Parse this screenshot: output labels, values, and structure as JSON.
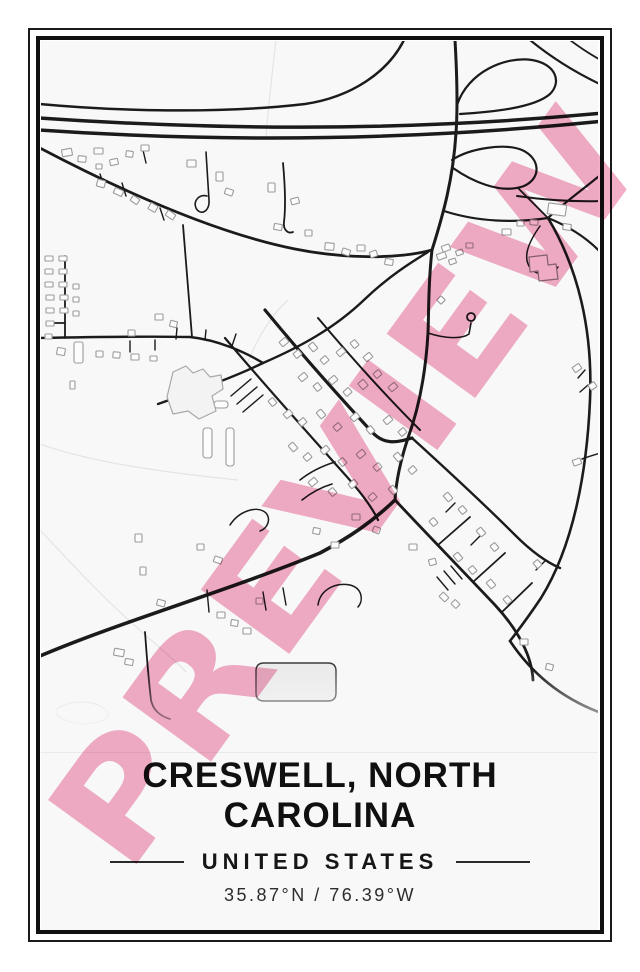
{
  "caption": {
    "title_line1": "CRESWELL, NORTH",
    "title_line2": "CAROLINA",
    "country": "UNITED STATES",
    "coordinates": "35.87°N / 76.39°W"
  },
  "watermark": {
    "text": "PREVIEW",
    "color": "#f2a7c2",
    "opacity": 0.92,
    "font_size": 150,
    "rotation": -54,
    "cx": 346,
    "cy": 489,
    "text_length": 885
  },
  "map": {
    "colors": {
      "background": "#f8f8f8",
      "road": "#1b1b1b",
      "building_stroke": "#9b9b9b",
      "building_fill": "#fcfcfc",
      "contour": "#e4e4e4",
      "frame": "#111111",
      "cut_line": "#eaeaea"
    },
    "roads": [
      {
        "d": "M404,40 C388,72 352,97 305,104 C220,114 115,111 40,104",
        "w": 2.5
      },
      {
        "d": "M40,118 C200,129 390,133 604,113",
        "w": 3.5
      },
      {
        "d": "M40,130 C200,141 390,143 604,121",
        "w": 3.5
      },
      {
        "d": "M455,40 C457,75 458,105 456,133 C453,180 443,215 432,250 C428,285 429,310 428,333 C426,368 420,405 408,438 C400,462 396,482 395,500",
        "w": 3
      },
      {
        "d": "M457,105 C468,72 505,56 532,60 C556,64 562,82 550,94 C534,108 492,112 460,114",
        "w": 2.2
      },
      {
        "d": "M452,160 C470,148 505,143 522,150 C540,158 542,178 524,186 C500,195 470,180 453,168",
        "w": 2.2
      },
      {
        "d": "M530,40 C552,58 578,74 604,86",
        "w": 2.2
      },
      {
        "d": "M570,40 C583,50 595,57 604,62",
        "w": 1.8
      },
      {
        "d": "M604,172 C585,188 565,202 548,218",
        "w": 2.2
      },
      {
        "d": "M517,196 C545,200 575,202 604,201",
        "w": 2
      },
      {
        "d": "M444,211 C478,222 515,223 548,218",
        "w": 2.2
      },
      {
        "d": "M548,218 C568,226 588,238 604,256",
        "w": 2.2
      },
      {
        "d": "M548,218 C537,207 527,197 518,188",
        "w": 1.8
      },
      {
        "d": "M548,218 C578,268 593,330 590,400 C587,470 574,545 541,598 C531,613 520,628 510,641",
        "w": 2.6
      },
      {
        "d": "M510,641 C536,680 570,702 604,714",
        "w": 2.6
      },
      {
        "d": "M40,148 C120,190 215,233 295,249 C340,258 395,260 432,250",
        "w": 2.8
      },
      {
        "d": "M158,404 C195,391 232,378 263,363 C300,347 335,328 365,299 C388,277 410,263 428,252",
        "w": 2.4
      },
      {
        "d": "M40,338 C90,337 140,336 190,337 C218,340 245,352 263,363",
        "w": 2.4
      },
      {
        "d": "M65,256 L65,338 M52,323 L65,323",
        "w": 1.8
      },
      {
        "d": "M183,225 C186,262 189,300 192,337",
        "w": 1.8
      },
      {
        "d": "M40,656 C120,622 230,590 320,553 C350,537 372,522 395,500",
        "w": 3.6
      },
      {
        "d": "M265,310 C298,350 335,392 372,432 C385,446 398,442 412,438",
        "w": 3.2
      },
      {
        "d": "M395,500 C425,532 460,568 495,605 C520,632 532,658 533,680",
        "w": 2.8
      },
      {
        "d": "M412,438 C445,468 480,500 515,535 C532,552 546,562 560,568",
        "w": 2.4
      },
      {
        "d": "M318,318 C350,356 385,395 420,430",
        "w": 2
      },
      {
        "d": "M225,338 C262,382 305,430 348,478 C362,494 372,507 378,520",
        "w": 2.2
      },
      {
        "d": "M438,545 L470,517 M473,582 L505,553 M502,612 L532,583",
        "w": 1.8
      },
      {
        "d": "M231,396 L251,379 M237,404 L257,387 M243,412 L263,395",
        "w": 1.4
      },
      {
        "d": "M130,341 L130,352 M155,340 L155,350 M176,339 L177,328 M205,340 L206,330 M232,346 L236,334",
        "w": 1.4
      },
      {
        "d": "M100,174 L104,186 M122,183 L126,196 M143,150 L146,163 M160,208 L164,220",
        "w": 1.4
      },
      {
        "d": "M206,152 L209,200 C210,212 200,216 196,208 C193,201 199,194 207,196",
        "w": 1.6
      },
      {
        "d": "M283,163 C285,185 286,205 284,222 C283,230 288,234 293,232",
        "w": 1.8
      },
      {
        "d": "M428,333 C446,339 462,339 469,334 L471,323",
        "w": 1.6
      },
      {
        "d": "M145,632 C147,660 149,683 151,700 C153,710 160,716 170,719",
        "w": 1.8
      },
      {
        "d": "M230,525 C239,511 257,505 266,513 C271,519 268,528 260,531",
        "w": 1.5
      },
      {
        "d": "M318,605 C320,590 335,582 350,585 C362,588 364,600 358,607",
        "w": 1.5
      },
      {
        "d": "M540,226 C528,243 522,258 531,269 C540,277 552,276 558,267",
        "w": 1.5
      },
      {
        "d": "M207,590 L209,612 M263,592 L266,610 M283,588 L286,605",
        "w": 1.4
      },
      {
        "d": "M437,577 L448,590 M444,571 L455,584 M451,566 L462,579",
        "w": 1.4
      },
      {
        "d": "M455,503 L446,512 M480,536 L471,545 M536,570 L545,561",
        "w": 1.4
      },
      {
        "d": "M582,459 C590,456 597,454 604,452",
        "w": 1.5
      },
      {
        "d": "M585,370 L578,378 M588,385 L580,392",
        "w": 1.4
      },
      {
        "d": "M300,480 C310,472 322,466 335,462 M302,500 C312,492 322,487 332,484",
        "w": 1.6
      }
    ],
    "circles": [
      {
        "cx": 471,
        "cy": 317,
        "r": 4
      }
    ],
    "contours": [
      {
        "d": "M276,40 C272,75 268,108 266,138"
      },
      {
        "d": "M288,300 C274,312 258,336 248,362"
      },
      {
        "d": "M40,444 C90,462 160,472 238,480"
      },
      {
        "d": "M40,530 C70,562 105,600 142,632 C162,650 175,660 186,672"
      },
      {
        "d": "M58,708 C76,698 100,701 108,713 C111,721 88,727 71,722 C59,718 52,714 58,708"
      }
    ],
    "shapes": [
      {
        "d": "M167,397 L173,372 L186,366 L193,373 L203,369 L210,377 L221,375 L223,389 L212,396 L216,411 L199,419 L188,411 L173,414 Z",
        "fill": "#f3f3f3",
        "stroke": "#a8a8a8",
        "sw": 1.2
      },
      {
        "d": "M529,257 L547,255 L548,265 L556,264 L558,279 L539,281 L538,271 L530,272 Z",
        "fill": "#fbfbfb",
        "stroke": "#8a8a8a",
        "sw": 1.2
      },
      {
        "d": "M264,663 L328,663 Q336,663 336,671 L336,693 Q336,701 328,701 L264,701 Q256,701 256,693 L256,671 Q256,663 264,663 Z",
        "fill": "#ebebeb",
        "stroke": "#3d3d3d",
        "sw": 1.4
      }
    ],
    "buildings": [
      [
        62,
        149,
        10,
        7,
        -10
      ],
      [
        78,
        156,
        8,
        6,
        5
      ],
      [
        94,
        148,
        9,
        6,
        0
      ],
      [
        110,
        159,
        8,
        6,
        -12
      ],
      [
        126,
        151,
        7,
        6,
        8
      ],
      [
        141,
        145,
        8,
        6,
        0
      ],
      [
        97,
        180,
        8,
        7,
        15
      ],
      [
        114,
        189,
        9,
        6,
        25
      ],
      [
        131,
        197,
        8,
        6,
        35
      ],
      [
        149,
        204,
        8,
        7,
        30
      ],
      [
        166,
        212,
        9,
        6,
        35
      ],
      [
        96,
        164,
        6,
        5,
        0
      ],
      [
        187,
        160,
        9,
        7,
        0
      ],
      [
        216,
        172,
        7,
        9,
        0
      ],
      [
        225,
        189,
        8,
        6,
        20
      ],
      [
        268,
        183,
        7,
        9,
        0
      ],
      [
        291,
        198,
        8,
        6,
        -15
      ],
      [
        274,
        224,
        8,
        6,
        10
      ],
      [
        305,
        230,
        7,
        6,
        0
      ],
      [
        325,
        243,
        9,
        7,
        5
      ],
      [
        342,
        249,
        8,
        6,
        20
      ],
      [
        357,
        245,
        8,
        6,
        0
      ],
      [
        370,
        251,
        7,
        6,
        -20
      ],
      [
        385,
        259,
        8,
        6,
        10
      ],
      [
        442,
        245,
        8,
        6,
        -20
      ],
      [
        456,
        250,
        7,
        5,
        -20
      ],
      [
        466,
        243,
        7,
        5,
        0
      ],
      [
        502,
        229,
        9,
        6,
        0
      ],
      [
        517,
        221,
        7,
        5,
        0
      ],
      [
        530,
        220,
        8,
        5,
        5
      ],
      [
        563,
        224,
        8,
        6,
        10
      ],
      [
        548,
        204,
        18,
        11,
        8
      ],
      [
        437,
        253,
        9,
        6,
        -20
      ],
      [
        449,
        259,
        7,
        5,
        -20
      ],
      [
        438,
        297,
        6,
        6,
        45
      ],
      [
        573,
        365,
        8,
        6,
        -35
      ],
      [
        589,
        383,
        7,
        6,
        -35
      ],
      [
        573,
        459,
        8,
        6,
        -20
      ],
      [
        45,
        256,
        8,
        5,
        0
      ],
      [
        59,
        256,
        8,
        5,
        0
      ],
      [
        45,
        269,
        8,
        5,
        0
      ],
      [
        59,
        269,
        8,
        5,
        0
      ],
      [
        45,
        282,
        8,
        5,
        0
      ],
      [
        59,
        282,
        8,
        5,
        0
      ],
      [
        46,
        295,
        8,
        5,
        0
      ],
      [
        60,
        295,
        8,
        5,
        0
      ],
      [
        46,
        308,
        8,
        5,
        0
      ],
      [
        60,
        308,
        8,
        5,
        0
      ],
      [
        46,
        321,
        8,
        5,
        0
      ],
      [
        73,
        284,
        6,
        5,
        0
      ],
      [
        73,
        297,
        6,
        5,
        0
      ],
      [
        73,
        311,
        6,
        5,
        0
      ],
      [
        45,
        334,
        7,
        5,
        0
      ],
      [
        70,
        381,
        5,
        8,
        0
      ],
      [
        155,
        314,
        8,
        6,
        0
      ],
      [
        170,
        321,
        7,
        6,
        15
      ],
      [
        57,
        348,
        8,
        7,
        10
      ],
      [
        96,
        351,
        7,
        6,
        0
      ],
      [
        113,
        352,
        7,
        6,
        5
      ],
      [
        131,
        354,
        8,
        6,
        0
      ],
      [
        150,
        356,
        7,
        5,
        0
      ],
      [
        128,
        330,
        7,
        6,
        0
      ],
      [
        74,
        342,
        9,
        21,
        0,
        2
      ],
      [
        203,
        428,
        9,
        30,
        0,
        3
      ],
      [
        226,
        428,
        8,
        38,
        0,
        3
      ],
      [
        214,
        401,
        14,
        7,
        0,
        3
      ],
      [
        280,
        339,
        8,
        6,
        -40
      ],
      [
        294,
        351,
        7,
        6,
        -40
      ],
      [
        309,
        344,
        8,
        6,
        50
      ],
      [
        321,
        357,
        7,
        6,
        -40
      ],
      [
        337,
        349,
        8,
        6,
        -40
      ],
      [
        351,
        341,
        7,
        6,
        50
      ],
      [
        364,
        354,
        8,
        6,
        -40
      ],
      [
        299,
        374,
        8,
        6,
        -40
      ],
      [
        314,
        384,
        7,
        6,
        50
      ],
      [
        329,
        377,
        8,
        6,
        -40
      ],
      [
        344,
        389,
        7,
        6,
        -40
      ],
      [
        359,
        381,
        8,
        7,
        50
      ],
      [
        374,
        371,
        7,
        6,
        -40
      ],
      [
        389,
        384,
        8,
        6,
        -40
      ],
      [
        269,
        399,
        7,
        6,
        50
      ],
      [
        284,
        411,
        8,
        6,
        -40
      ],
      [
        299,
        419,
        7,
        6,
        -40
      ],
      [
        317,
        411,
        8,
        6,
        50
      ],
      [
        334,
        424,
        7,
        6,
        -40
      ],
      [
        351,
        414,
        8,
        6,
        -40
      ],
      [
        367,
        427,
        7,
        6,
        50
      ],
      [
        384,
        417,
        8,
        6,
        -40
      ],
      [
        399,
        429,
        7,
        6,
        -40
      ],
      [
        289,
        444,
        8,
        6,
        50
      ],
      [
        304,
        454,
        7,
        6,
        -40
      ],
      [
        321,
        447,
        8,
        6,
        -40
      ],
      [
        339,
        459,
        7,
        6,
        50
      ],
      [
        357,
        451,
        8,
        6,
        -40
      ],
      [
        374,
        464,
        7,
        6,
        -40
      ],
      [
        394,
        454,
        8,
        6,
        50
      ],
      [
        409,
        467,
        7,
        6,
        -40
      ],
      [
        309,
        479,
        8,
        6,
        -40
      ],
      [
        329,
        489,
        7,
        6,
        50
      ],
      [
        349,
        481,
        8,
        6,
        -40
      ],
      [
        369,
        494,
        7,
        6,
        -40
      ],
      [
        389,
        487,
        8,
        6,
        50
      ],
      [
        444,
        494,
        8,
        6,
        50
      ],
      [
        459,
        507,
        7,
        6,
        50
      ],
      [
        477,
        529,
        8,
        6,
        50
      ],
      [
        491,
        544,
        7,
        6,
        50
      ],
      [
        454,
        554,
        8,
        6,
        50
      ],
      [
        469,
        567,
        7,
        6,
        50
      ],
      [
        487,
        581,
        8,
        6,
        50
      ],
      [
        504,
        597,
        7,
        6,
        50
      ],
      [
        534,
        561,
        7,
        6,
        50
      ],
      [
        430,
        519,
        7,
        6,
        50
      ],
      [
        440,
        594,
        8,
        6,
        45
      ],
      [
        452,
        601,
        7,
        6,
        45
      ],
      [
        313,
        528,
        7,
        6,
        10
      ],
      [
        331,
        542,
        8,
        6,
        0
      ],
      [
        114,
        649,
        10,
        7,
        10
      ],
      [
        125,
        659,
        8,
        6,
        10
      ],
      [
        135,
        534,
        7,
        8,
        0
      ],
      [
        140,
        567,
        6,
        8,
        0
      ],
      [
        157,
        600,
        8,
        6,
        15
      ],
      [
        197,
        544,
        7,
        6,
        0
      ],
      [
        214,
        557,
        8,
        6,
        20
      ],
      [
        217,
        612,
        8,
        6,
        0
      ],
      [
        231,
        620,
        7,
        6,
        10
      ],
      [
        243,
        628,
        8,
        6,
        0
      ],
      [
        256,
        598,
        7,
        6,
        0
      ],
      [
        352,
        514,
        8,
        6,
        0
      ],
      [
        373,
        527,
        7,
        6,
        20
      ],
      [
        409,
        544,
        8,
        6,
        0
      ],
      [
        429,
        559,
        7,
        6,
        -15
      ],
      [
        520,
        639,
        8,
        6,
        0
      ],
      [
        546,
        664,
        7,
        6,
        15
      ]
    ]
  }
}
